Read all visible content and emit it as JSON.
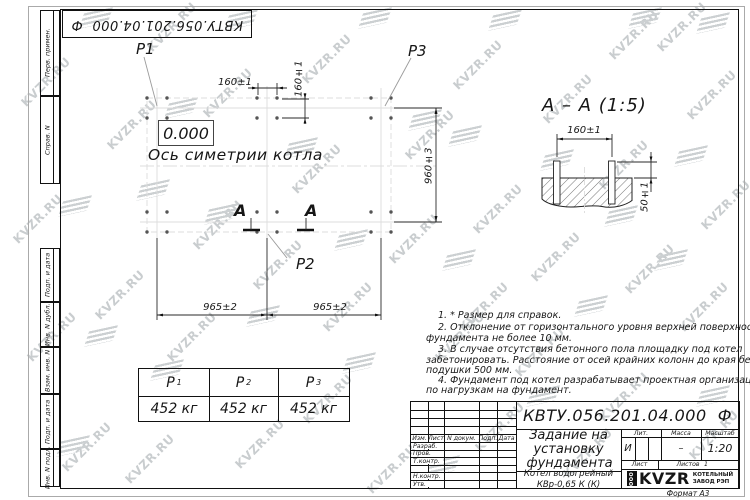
{
  "watermark": {
    "text": "KVZR.RU"
  },
  "stamp": {
    "doc_number_rotated": "КВТУ.056.201.04.000  Ф"
  },
  "margin": {
    "labels": [
      "Перв. примен.",
      "Справ. N",
      "Подп. и дата",
      "Инв. N дубл.",
      "Взам. инв. N",
      "Подп. и дата",
      "Инв. N подл."
    ]
  },
  "plan": {
    "labels": {
      "p1": "P1",
      "p2": "P2",
      "p3": "P3"
    },
    "elevation": "0.000",
    "axis_label": "Ось симетрии котла",
    "section_letter": "А",
    "dims": {
      "bolt_spacing_h": "160±1",
      "bolt_spacing_v": "160±1",
      "row_spacing": "960±3",
      "col_spacing_left": "965±2",
      "col_spacing_right": "965±2"
    }
  },
  "section": {
    "title": "А – А (1:5)",
    "dims": {
      "bolt_spacing": "160±1",
      "protrusion": "50±1"
    }
  },
  "notes": {
    "lines": [
      "1. * Размер для справок.",
      "2. Отклонение от горизонтального уровня верхней поверхности",
      "фундамента не более 10 мм.",
      "3. В случае отсутствия бетонного пола площадку под котел",
      "забетонировать. Расстояние от осей крайних колонн до края бетонной",
      "подушки 500 мм.",
      "4. Фундамент под котел разрабатывает проектная организация",
      "по нагрузкам на фундамент."
    ]
  },
  "load_table": {
    "headers": [
      {
        "base": "P",
        "sub": "1"
      },
      {
        "base": "P",
        "sub": "2"
      },
      {
        "base": "P",
        "sub": "3"
      }
    ],
    "values": [
      "452 кг",
      "452 кг",
      "452 кг"
    ]
  },
  "title_block": {
    "doc_number": "КВТУ.056.201.04.000  Ф",
    "title": "Задание на установку фундамента",
    "product": "Котел водогрейный КВр-0,65 К (К)",
    "columns": [
      "Изм.",
      "Лист",
      "N докум.",
      "Подп.",
      "Дата"
    ],
    "rows": [
      "Разраб.",
      "Пров.",
      "Т.контр.",
      "Н.контр.",
      "Утв."
    ],
    "lit_label": "Лит.",
    "massa_label": "Масса",
    "masshtab_label": "Масштаб",
    "lit_value": "И",
    "massa_value": "–",
    "scale": "1:20",
    "list_label": "Лист",
    "listov_label": "Листов",
    "listov_value": "1",
    "logo": {
      "prefix": "ООО",
      "name": "KVZR",
      "tagline_line1": "КОТЕЛЬНЫЙ",
      "tagline_line2": "ЗАВОД РЭП"
    },
    "format_label": "Формат А3"
  }
}
